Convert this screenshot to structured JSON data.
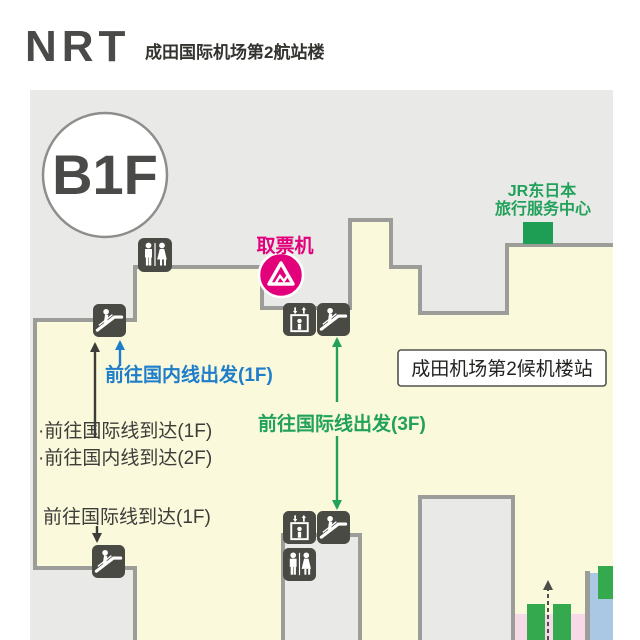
{
  "header": {
    "airport_code": "NRT",
    "terminal_title": "成田国际机场第2航站楼"
  },
  "map": {
    "floor_badge": "B1F",
    "ticket_machine_label": "取票机",
    "jr_travel_center": {
      "line1": "JR东日本",
      "line2": "旅行服务中心"
    },
    "station_label": "成田机场第2候机楼站",
    "routes": {
      "domestic_departure": "前往国内线出发(1F)",
      "international_arrival_bullet": "·前往国际线到达(1F)",
      "domestic_arrival_bullet": "·前往国内线到达(2F)",
      "international_departure": "前往国际线出发(3F)",
      "international_arrival": "前往国际线到达(1F)"
    },
    "icon_names": [
      "restroom-icon",
      "escalator-icon",
      "elevator-icon",
      "ticket-machine-icon",
      "jr-service-center-marker"
    ],
    "colors": {
      "floor_fill": "#fbf9dc",
      "map_background": "#e9e9e7",
      "wall": "#9c9c99",
      "icon_background": "#4a4a44",
      "accent_pink": "#e2017b",
      "accent_green": "#21a15a",
      "accent_blue": "#1e7ec9",
      "zone_pink": "#f7d9e8",
      "zone_blue": "#aac8e4",
      "bar_green": "#35a94d",
      "text_dark": "#3c3c38"
    }
  }
}
